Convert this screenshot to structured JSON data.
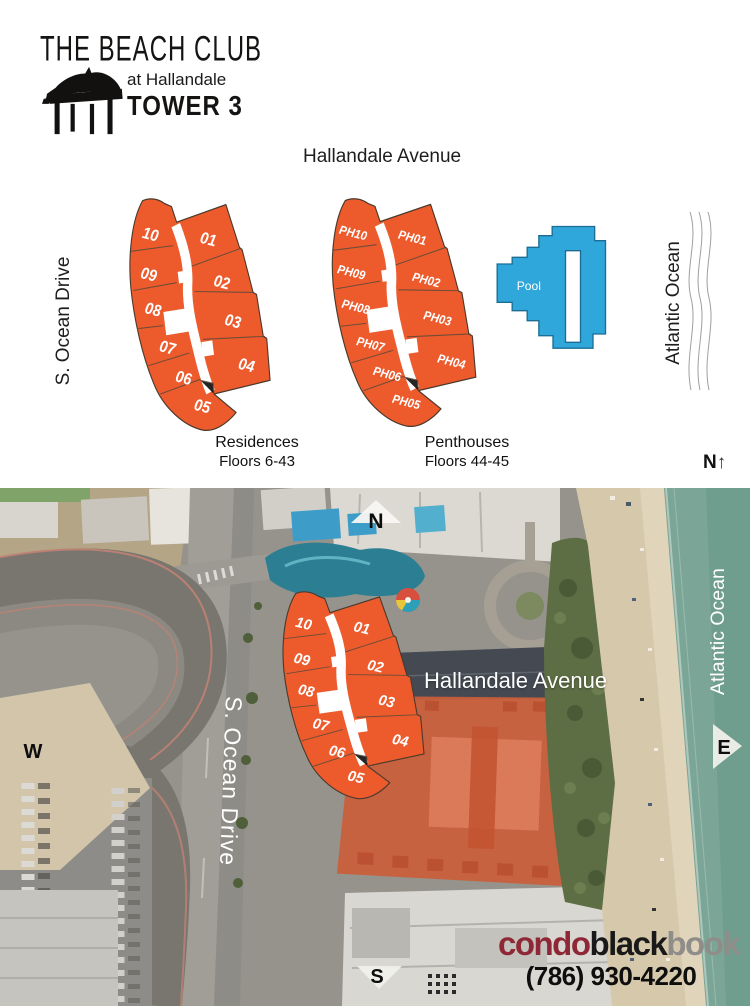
{
  "logo": {
    "title": "THE BEACH CLUB",
    "subtitle": "at Hallandale",
    "tower": "TOWER 3"
  },
  "plan": {
    "street_top": "Hallandale Avenue",
    "street_left": "S. Ocean Drive",
    "ocean_label": "Atlantic Ocean",
    "north_label": "N",
    "north_arrow": "↑",
    "pool_label": "Pool",
    "residences": {
      "caption_title": "Residences",
      "caption_floors": "Floors 6-43",
      "units": {
        "u10": "10",
        "u09": "09",
        "u08": "08",
        "u07": "07",
        "u06": "06",
        "u05": "05",
        "u01": "01",
        "u02": "02",
        "u03": "03",
        "u04": "04"
      }
    },
    "penthouses": {
      "caption_title": "Penthouses",
      "caption_floors": "Floors 44-45",
      "units": {
        "u10": "PH10",
        "u09": "PH09",
        "u08": "PH08",
        "u07": "PH07",
        "u06": "PH06",
        "u05": "PH05",
        "u01": "PH01",
        "u02": "PH02",
        "u03": "PH03",
        "u04": "PH04"
      }
    }
  },
  "map": {
    "compass": {
      "north": "N",
      "south": "S",
      "east": "E",
      "west": "W"
    },
    "street_label": "Hallandale Avenue",
    "street_left_label": "S. Ocean Drive",
    "ocean_label": "Atlantic Ocean",
    "units": {
      "u10": "10",
      "u09": "09",
      "u08": "08",
      "u07": "07",
      "u06": "06",
      "u05": "05",
      "u01": "01",
      "u02": "02",
      "u03": "03",
      "u04": "04"
    }
  },
  "footer": {
    "brand_condo": "condo",
    "brand_black": "black",
    "brand_book": "book",
    "phone": "(786) 930-4220"
  },
  "colors": {
    "unit_orange": "#ED5B2D",
    "pool_blue": "#2FA7DB",
    "roof_overlay": "#CB5D3A",
    "ocean_green": "#7BA697"
  }
}
